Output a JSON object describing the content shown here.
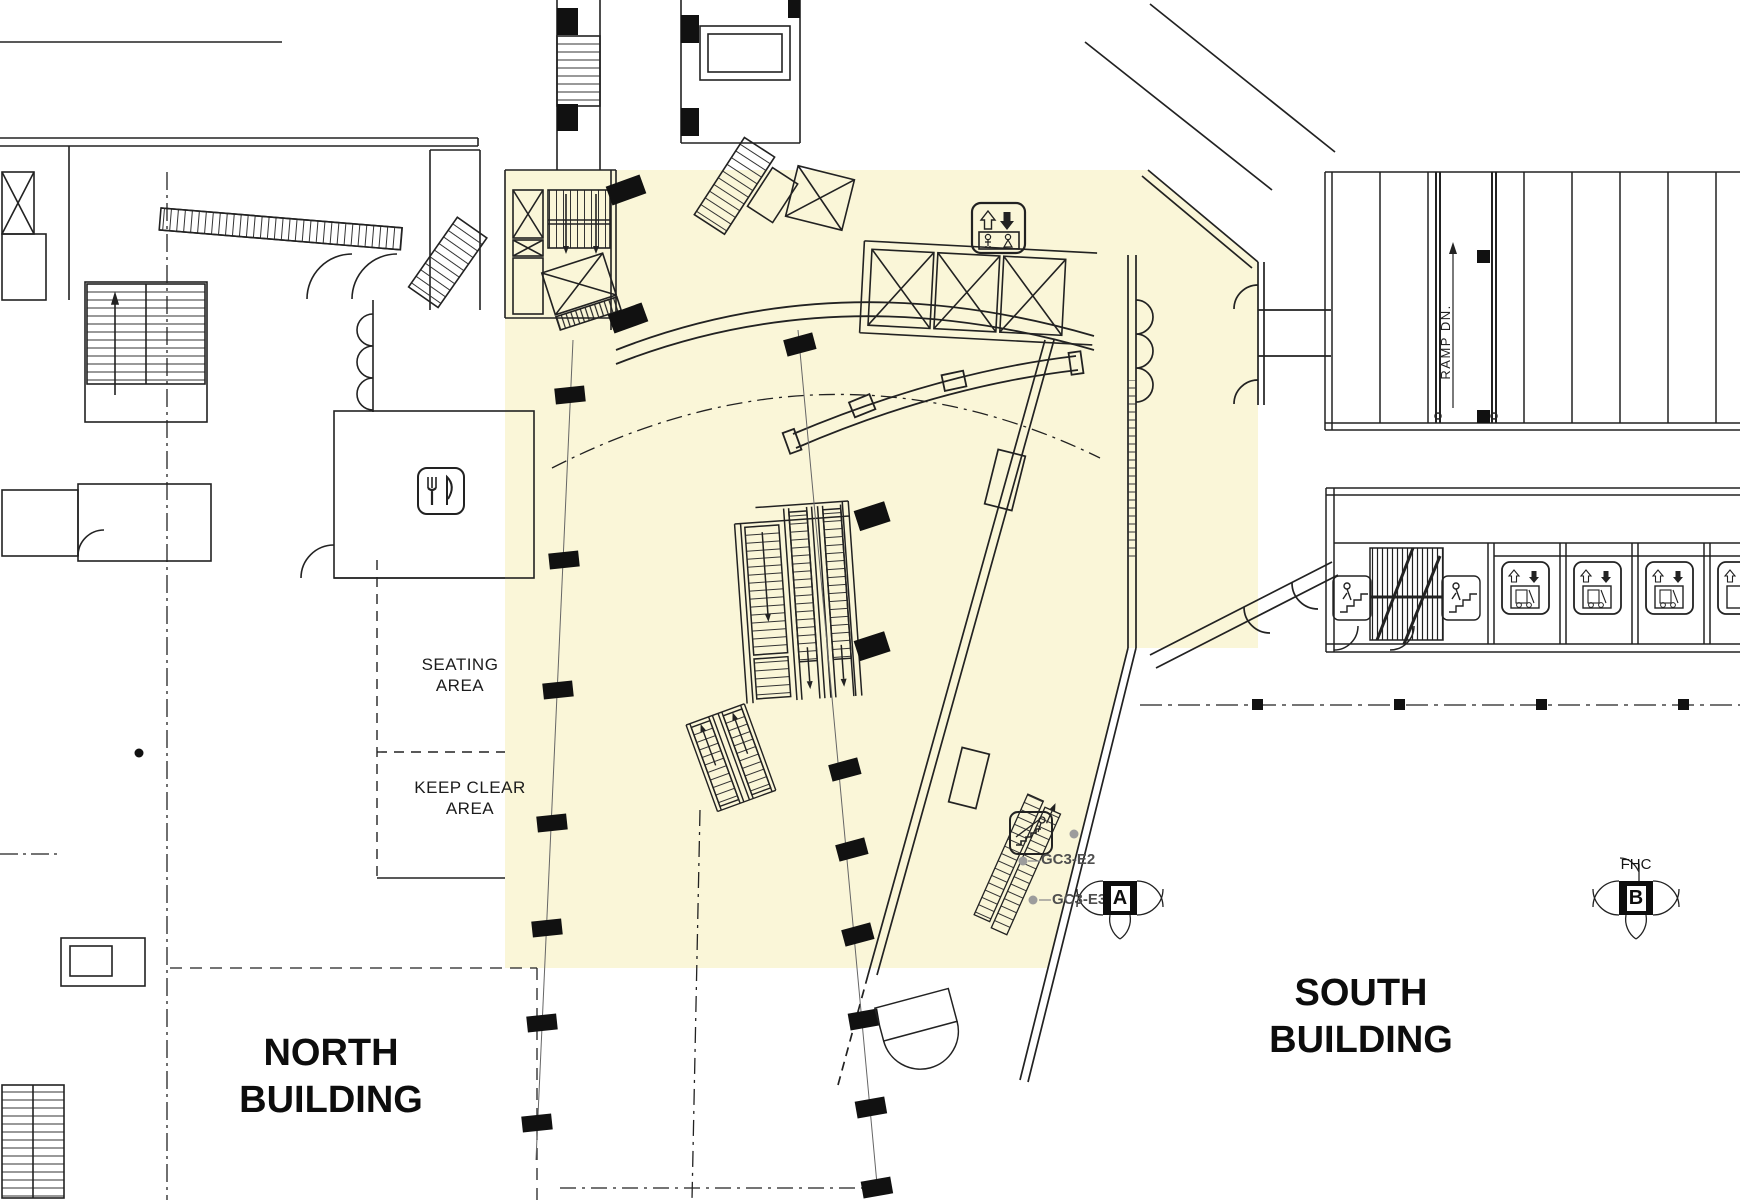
{
  "plan": {
    "buildings": {
      "north_line1": "NORTH",
      "north_line2": "BUILDING",
      "south_line1": "SOUTH",
      "south_line2": "BUILDING"
    },
    "areas": {
      "seating_line1": "SEATING",
      "seating_line2": "AREA",
      "keep_clear_line1": "KEEP CLEAR",
      "keep_clear_line2": "AREA"
    },
    "annotations": {
      "ramp_label": "RAMP DN.",
      "escalator_id_upper": "GC3-E2",
      "escalator_id_lower": "GC3-E3",
      "fhc_label": "FHC",
      "column_marker_a": "A",
      "column_marker_b": "B"
    },
    "colors": {
      "highlight_fill": "#FAF6D8",
      "wall_line": "#222222",
      "annotation_gray": "#4f4f4f",
      "dot_gray": "#9c9c9c"
    },
    "icons": [
      "passenger-elevator-icon",
      "freight-elevator-icon",
      "restaurant-icon",
      "escalator-icon",
      "stair-person-icon",
      "fire-hose-cabinet-marker"
    ]
  }
}
